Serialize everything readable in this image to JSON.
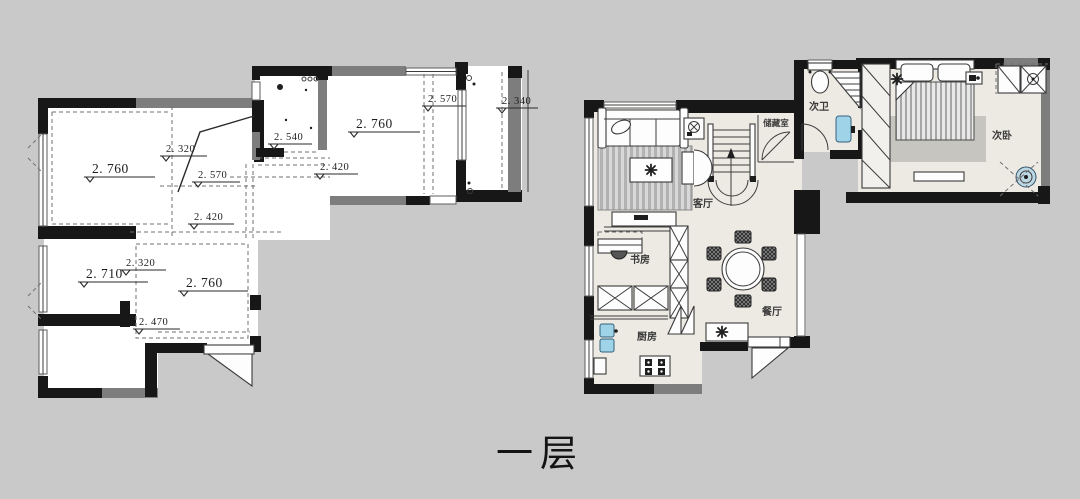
{
  "title": "一层",
  "left_plan": {
    "levels": [
      {
        "value": "2. 760"
      },
      {
        "value": "2. 320"
      },
      {
        "value": "2. 570"
      },
      {
        "value": "2. 540"
      },
      {
        "value": "2. 760"
      },
      {
        "value": "2. 570"
      },
      {
        "value": "2. 340"
      },
      {
        "value": "2. 420"
      },
      {
        "value": "2. 420"
      },
      {
        "value": "2. 710"
      },
      {
        "value": "2. 320"
      },
      {
        "value": "2. 760"
      },
      {
        "value": "2. 470"
      }
    ]
  },
  "right_plan": {
    "rooms": [
      {
        "label": "客厅"
      },
      {
        "label": "书房"
      },
      {
        "label": "厨房"
      },
      {
        "label": "餐厅"
      },
      {
        "label": "储藏室"
      },
      {
        "label": "次卫"
      },
      {
        "label": "次卧"
      }
    ]
  },
  "colors": {
    "background": "#c9c9c9",
    "wall": "#171717",
    "wall_secondary": "#7d7d7d",
    "left_floor": "#ffffff",
    "right_floor": "#edeae3",
    "fixture_blue": "#9fd4e8"
  },
  "icons": {
    "level_mark": "▽",
    "flower": "✳"
  }
}
